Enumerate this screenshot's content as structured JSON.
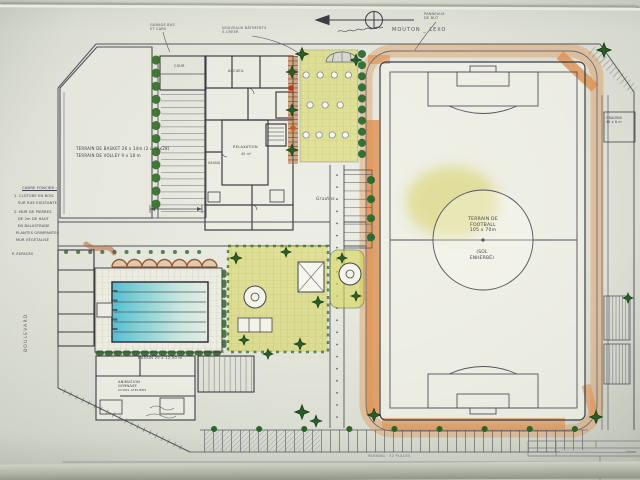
{
  "title": "Plan masse - complexe sportif (dessin main)",
  "texts": {
    "courts1": "TERRAIN DE BASKET 26 x 14m (2 u 15x28)",
    "courts2": "TERRAIN DE VOLLEY 9 x 18 m",
    "field1": "TERRAIN DE",
    "field2": "FOOTBALL",
    "field3": "105 x 70m",
    "field4": "(SOL",
    "field5": "ENHERBÉ)",
    "compass": "MOUTON _ LEXO",
    "noteA1": "GARAGE BUS",
    "noteA2": "ET CARS",
    "noteB1": "NOUVEAUX BÂTIMENTS",
    "noteB2": "À CRÉER",
    "noteC1": "PANNEAUX",
    "noteC2": "DE BUT",
    "stands1": "GRADINS",
    "stands2": "40 x 6 m",
    "bassin": "BASSIN 25 x 12,50 m",
    "vestiaires": "VESTIAIRES",
    "gym1": "ANIMATION",
    "gym2": "GYMNASE",
    "gym3": "COURS ATELIERS",
    "accueil": "ACCUEIL",
    "cour": "COUR",
    "relax": "RELAXATION",
    "relax_m2": "45 m²",
    "sauna": "SAUNA",
    "gradins_cursive": "Gradins",
    "boulevard": "BOULEVARD",
    "parking": "PARKING · 52 PLACES",
    "brand": "TOTAL"
  },
  "margin_notes": {
    "lines": [
      "CADRE FONCIER :",
      "1. CLÔTURE EN BOIS",
      "SUR RUE EXISTANTE",
      "2. MUR DE PIERRES",
      "DE 2m DE HAUT",
      "EN BALUSTRADE",
      "PLANTES GRIMPANTES",
      "MUR VÉGÉTALISÉ",
      "P. ESPACES"
    ]
  },
  "colors": {
    "track": "#dd9050",
    "field_smudge": "#d4ce57",
    "pool_water": "#56c0d2",
    "garden": "#d6d655",
    "tree": "#2f6b2f",
    "flower": "#c03428",
    "brand_blue": "#16338e"
  }
}
